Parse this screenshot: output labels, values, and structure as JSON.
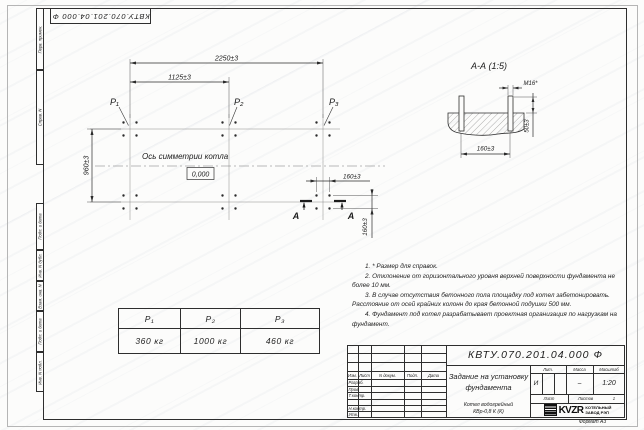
{
  "sheet": {
    "doc_number": "КВТУ.070.201.04.000 Ф",
    "format_label": "Формат А3"
  },
  "margin_labels": {
    "perv": "Перв. примен.",
    "sprav": "Справ. N",
    "podp1": "Подп. и дата",
    "inv_dubl": "Инв. N дубл.",
    "vzam": "Взам. инв. N",
    "podp2": "Подп. и дата",
    "inv_podl": "Инв. N подл."
  },
  "plan": {
    "dim_width_total": "2250±3",
    "dim_width_half": "1125±3",
    "dim_depth": "960±3",
    "dim_bolt_h": "160±3",
    "dim_bolt_v": "160±3",
    "axis_label": "Ось симметрии котла",
    "elevation": "0,000",
    "p1_label": "P₁",
    "p2_label": "P₂",
    "p3_label": "P₃",
    "section_letter_left": "А",
    "section_letter_right": "А"
  },
  "section_aa": {
    "title": "А-А (1:5)",
    "bolt_thread": "М16*",
    "dim_height": "50±3",
    "dim_spacing": "160±3"
  },
  "notes": {
    "items": [
      "1. * Размер для справок.",
      "2. Отклонение от горизонтального уровня верхней поверхности фундамента не более 10 мм.",
      "3. В случае отсутствия бетонного пола площадку под котел забетонировать. Расстояние от осей крайних колонн до края бетонной подушки 500 мм.",
      "4. Фундамент под котел разрабатывает проектная организация по нагрузкам на фундамент."
    ]
  },
  "load_table": {
    "headers": [
      "P₁",
      "P₂",
      "P₃"
    ],
    "values": [
      "360 кг",
      "1000 кг",
      "460 кг"
    ]
  },
  "title_block": {
    "doc_number": "КВТУ.070.201.04.000 Ф",
    "title": "Задание на установку фундамента",
    "product_line1": "Котел водогрейный",
    "product_line2": "КВр-0,8 К (К)",
    "col_izm": "Изм.",
    "col_list": "Лист",
    "col_doc": "N докум.",
    "col_podp": "Подп.",
    "col_data": "Дата",
    "row_razrab": "Разраб.",
    "row_prov": "Пров.",
    "row_tkontr": "Т.контр.",
    "row_nkontr": "Н.контр.",
    "row_utv": "Утв.",
    "lit_header": "Лит.",
    "mass_header": "Масса",
    "scale_header": "Масштаб",
    "lit_value": "И",
    "mass_value": "–",
    "scale_value": "1:20",
    "sheet_label": "Лист",
    "sheets_label": "Листов",
    "sheets_value": "1",
    "logo_text": "KVZR",
    "org_line1": "КОТЕЛЬНЫЙ",
    "org_line2": "ЗАВОД РЭП"
  }
}
